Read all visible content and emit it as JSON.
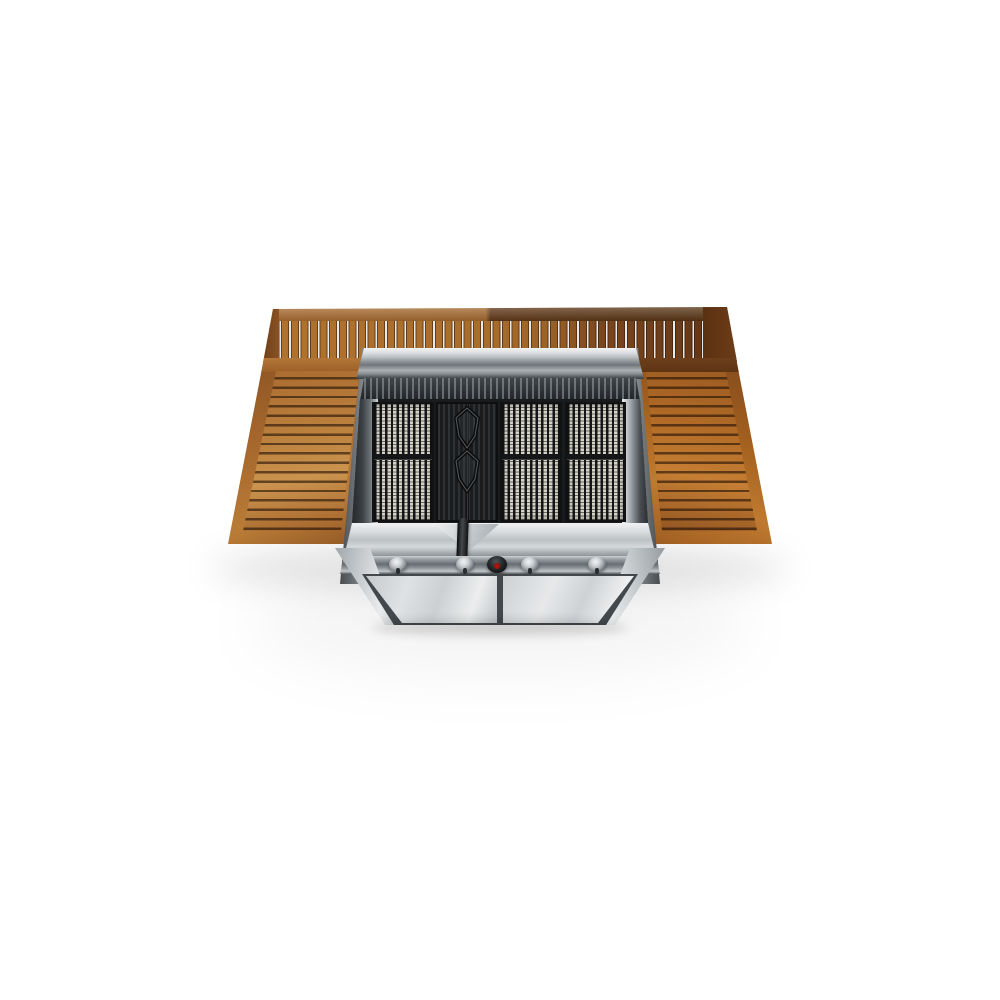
{
  "meta": {
    "domain": "Natural-Image",
    "description": "Studio product photograph of a stainless-steel gas barbecue grill seen from the front at a high angle, with slatted teak wood side tables and a slatted teak back panel, three bright cooking grates, a dark cast-iron griddle strip with two diamond lifter handles and a black-handled tool, four burner control knobs with a central red piezo ignition button, and a two-door stainless cabinet base casting a soft shadow on a white studio floor."
  },
  "product": {
    "name": "gas-barbecue-grill-with-teak-side-tables",
    "materials": [
      "stainless steel",
      "teak wood",
      "cast iron"
    ],
    "counts": {
      "burner_knobs": 4,
      "ignition_buttons": 1,
      "grate_panels": 3,
      "griddle_handles": 2,
      "cabinet_doors": 2,
      "side_shelves": 2,
      "back_panels": 1
    }
  },
  "colors": {
    "background": "#ffffff",
    "wood-light": "#cb944e",
    "wood-mid": "#a96a2e",
    "wood-dark": "#7b451c",
    "wood-walnut": "#5e3514",
    "slat-gap-bright": "#e8e9ea",
    "steel-bright": "#f0f2f3",
    "steel-light": "#d6dadc",
    "steel-mid": "#aab0b4",
    "steel-dark": "#6d7377",
    "steel-deep": "#3a3f43",
    "grate-frame": "#101214",
    "grate-dark": "#191b1d",
    "grate-rod": "#d6d2c6",
    "griddle-rib": "#2f3235",
    "handle-black": "#0a0b0c",
    "ignition-red": "#7e0f06"
  }
}
